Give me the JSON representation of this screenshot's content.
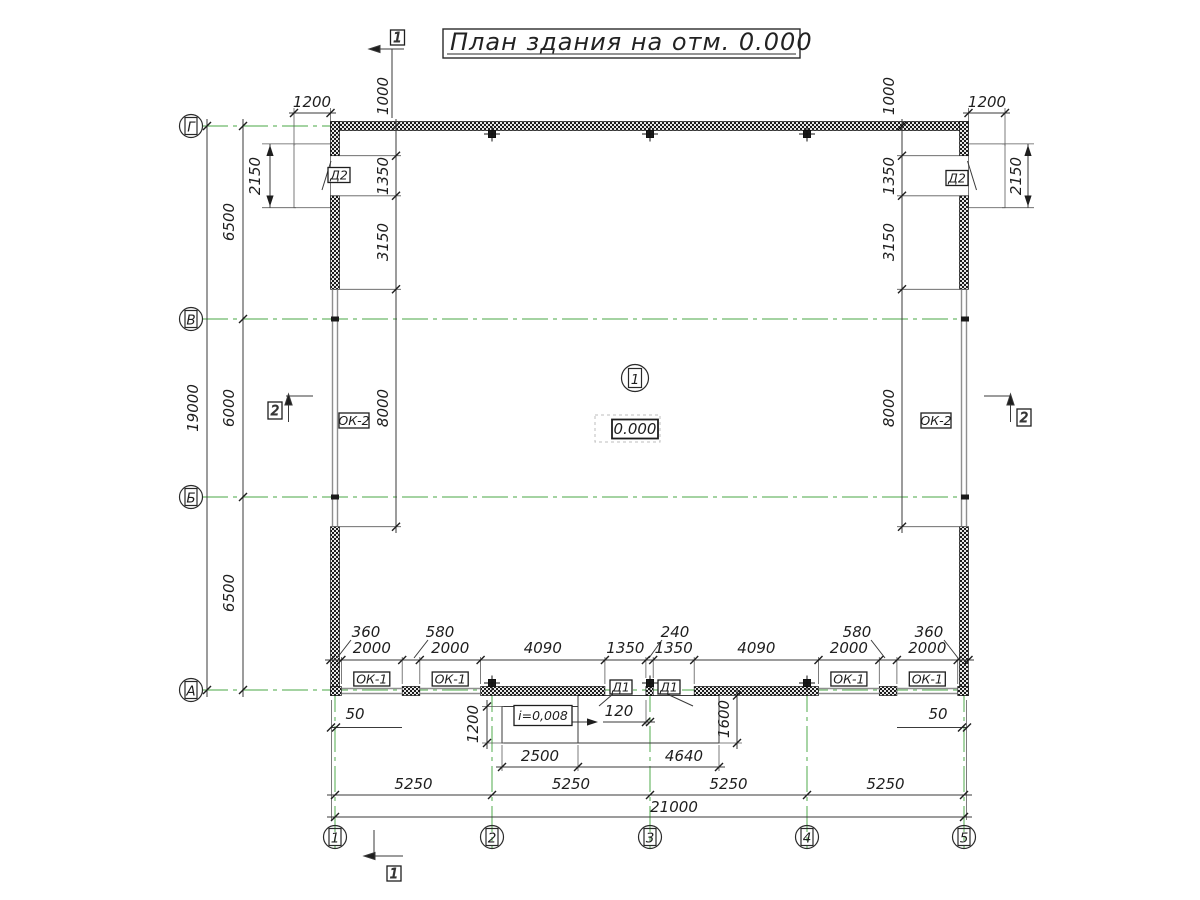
{
  "title": "План здания на отм. 0.000",
  "room": {
    "number": "1",
    "elevation": "0.000"
  },
  "labels": {
    "d1": "Д1",
    "d2": "Д2",
    "ok1": "ОК-1",
    "ok2": "ОК-2",
    "slope": "i=0,008"
  },
  "axes": {
    "horizontal": [
      "Г",
      "В",
      "Б",
      "А"
    ],
    "vertical": [
      "1",
      "2",
      "3",
      "4",
      "5"
    ]
  },
  "sections": {
    "s1": "1",
    "s2": "2"
  },
  "dims": {
    "left": {
      "total": "19000",
      "spans": [
        "6500",
        "6000",
        "6500"
      ]
    },
    "porch": {
      "width": "1200",
      "height": "2150"
    },
    "wall_chain": [
      "1000",
      "1350",
      "3150",
      "8000"
    ],
    "bottom_chain": [
      "2000",
      "2000",
      "4090",
      "1350",
      "1350",
      "4090",
      "2000",
      "2000"
    ],
    "bottom_leaders": [
      "360",
      "580",
      "240",
      "580",
      "360"
    ],
    "ramp": {
      "w1": "2500",
      "w2": "4640",
      "depth1": "1200",
      "depth2": "1600",
      "offset": "120",
      "gap": "50"
    },
    "bottom": {
      "spans": [
        "5250",
        "5250",
        "5250",
        "5250"
      ],
      "total": "21000"
    }
  },
  "colors": {
    "axis_green": "#6db96a",
    "wall": "#1c1c1c",
    "line": "#333333",
    "window": "#8f8f8f"
  }
}
